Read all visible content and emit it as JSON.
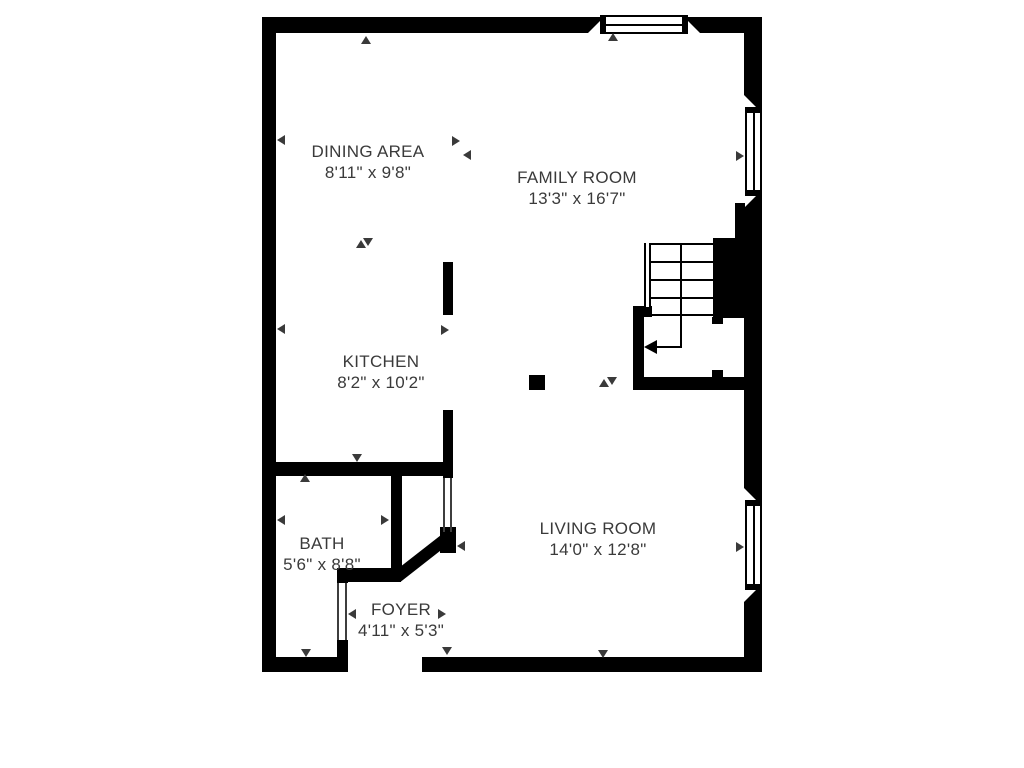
{
  "title": "Floor plan",
  "colors": {
    "wall": "#000000",
    "label_text": "#3a3a3a",
    "background": "#ffffff"
  },
  "floorplan": {
    "rooms": [
      {
        "id": "dining",
        "name": "DINING AREA",
        "dims": "8'11\" x 9'8\""
      },
      {
        "id": "family",
        "name": "FAMILY ROOM",
        "dims": "13'3\" x 16'7\""
      },
      {
        "id": "kitchen",
        "name": "KITCHEN",
        "dims": "8'2\" x 10'2\""
      },
      {
        "id": "bath",
        "name": "BATH",
        "dims": "5'6\" x 8'8\""
      },
      {
        "id": "living",
        "name": "LIVING ROOM",
        "dims": "14'0\" x 12'8\""
      },
      {
        "id": "foyer",
        "name": "FOYER",
        "dims": "4'11\" x 5'3\""
      }
    ],
    "features": {
      "windows": 3,
      "staircase": "L-shaped stairs with down-direction arrow",
      "entry": "opening in bottom wall below foyer"
    },
    "icons": {
      "dimension-arrow-left": "◀",
      "dimension-arrow-right": "▶",
      "dimension-arrow-up": "▲",
      "dimension-arrow-down": "▼",
      "stairs-direction-arrow": "◀"
    }
  }
}
